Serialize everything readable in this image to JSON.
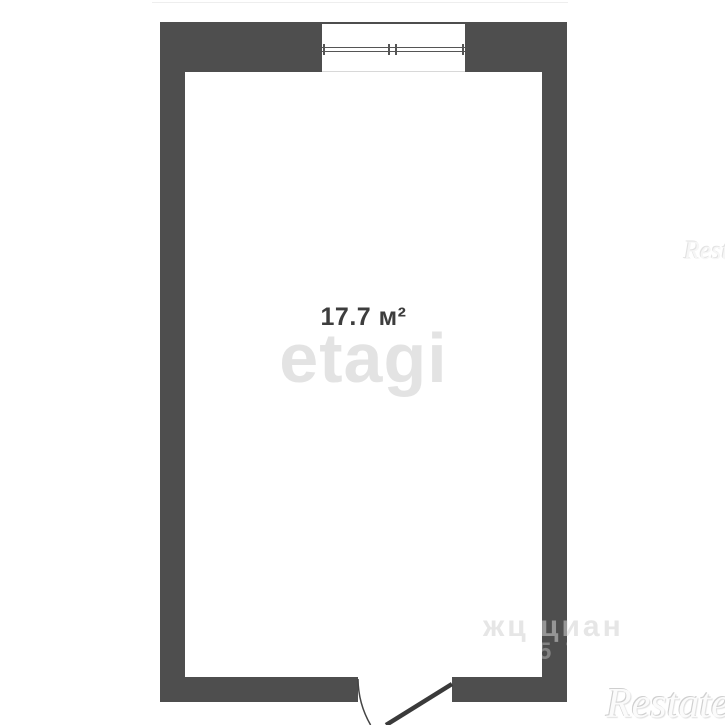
{
  "floorplan": {
    "room": {
      "area_label": "17.7 м²"
    },
    "watermarks": {
      "etagi": "etagi",
      "restate_bottom": "Restate",
      "restate_mid": "Restate",
      "cian_faint": "жц циан",
      "wall_digits": "57"
    },
    "colors": {
      "wall": "#4e4e4e",
      "background": "#ffffff",
      "etagi_watermark": "#e3e3e3",
      "label_text": "#3d3d3d"
    }
  }
}
